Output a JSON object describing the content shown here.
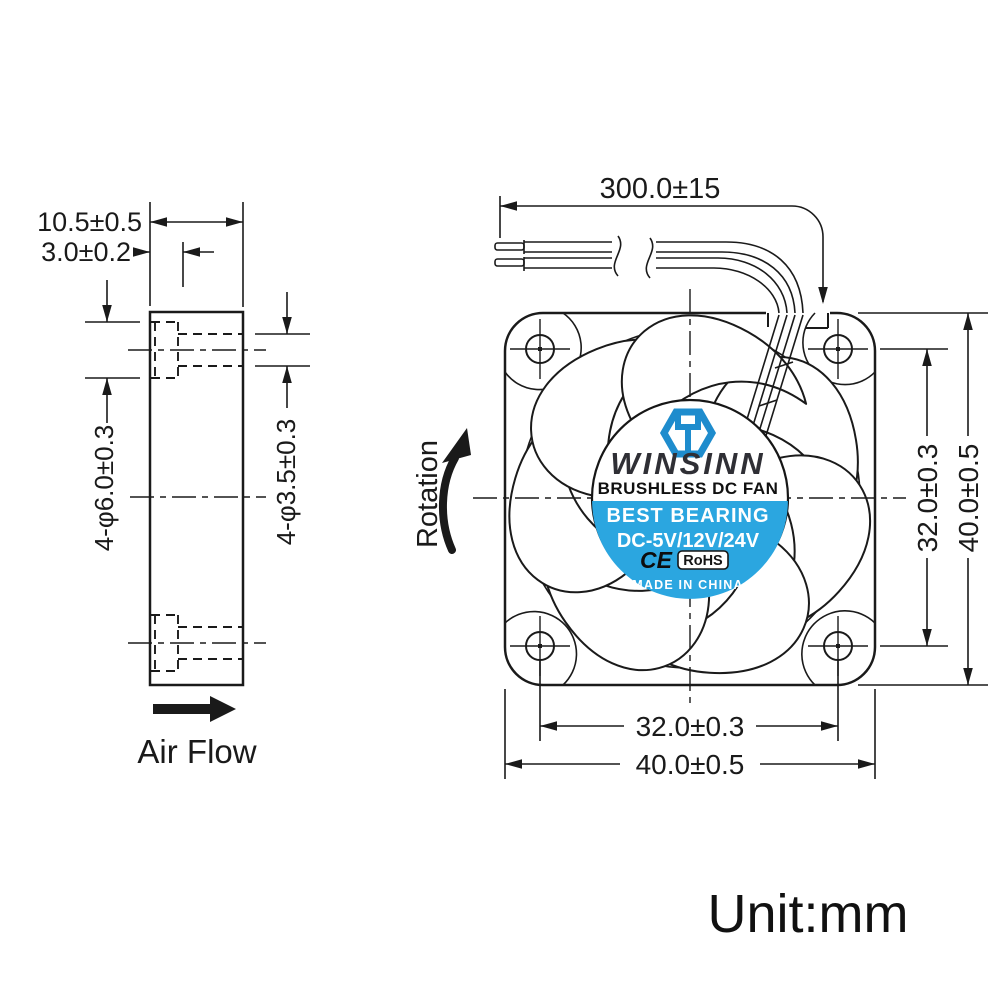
{
  "unit_label": "Unit:mm",
  "side_view": {
    "thickness_dim": "10.5±0.5",
    "flange_dim": "3.0±0.2",
    "mount_hole_dim": "4-φ6.0±0.3",
    "through_hole_dim": "4-φ3.5±0.3",
    "air_flow_label": "Air Flow"
  },
  "front_view": {
    "rotation_label": "Rotation",
    "lead_wire_dim": "300.0±15",
    "hole_pitch_vertical_dim": "32.0±0.3",
    "height_dim": "40.0±0.5",
    "hole_pitch_horizontal_dim": "32.0±0.3",
    "width_dim": "40.0±0.5"
  },
  "fan_label": {
    "brand": "WINSINN",
    "product": "BRUSHLESS DC FAN",
    "feature": "BEST BEARING",
    "voltages": "DC-5V/12V/24V",
    "ce_mark": "CE",
    "rohs_mark": "RoHS",
    "origin": "MADE IN CHINA"
  },
  "colors": {
    "line": "#1a1a1a",
    "label_blue": "#2ba6e0",
    "logo_blue": "#1e8ccd",
    "brand_text": "#2f2f35",
    "background": "#ffffff"
  }
}
